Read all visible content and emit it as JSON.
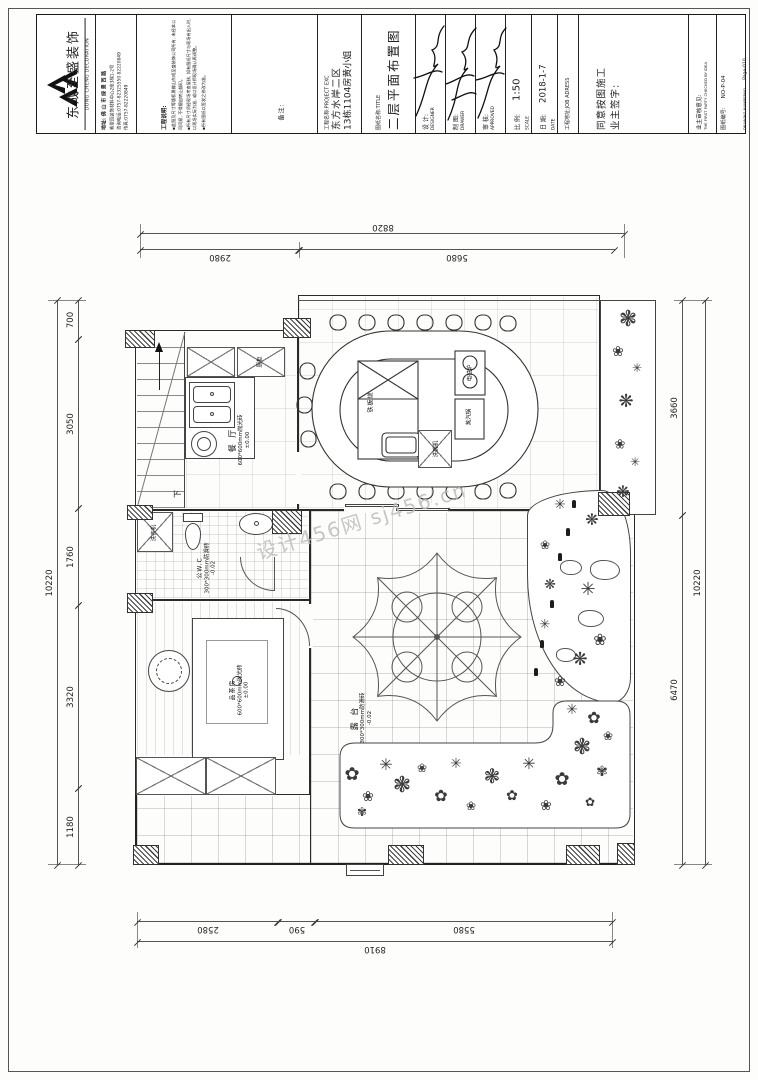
{
  "watermark": "设计456网 sj456.cn",
  "icons": {
    "flower_a": "✿",
    "flower_b": "❀",
    "flower_c": "✾",
    "star": "✳",
    "burst": "❋",
    "tree": "❃"
  },
  "title_block": {
    "company": {
      "name": "东成至盛装饰",
      "name_en": "DONG CHENG DECORATION",
      "address_line1": "地址: 佛 山 市 绿 景 西 路",
      "address_line2": "紫翠园装饰材料中心2座3梯1-2号",
      "tel": "咨询电话:0757-82325550 82220849",
      "fax": "传真:0757-82220849"
    },
    "notes": {
      "heading": "工程说明:",
      "item1": "▪此图及尺寸等版权属佛山东成至盛装饰公司所有, 未经本公司同意, 不得擅自转让翻印。",
      "item2": "▪所有尺寸须经现场考查复核, 如有图纸尺寸与现场有出入时, 以现场实际为准, 或以设计师现场确认再调整。",
      "item3": "▪所有图纸以签发之修改为准。"
    },
    "remark": "备注:",
    "project": {
      "label": "工程名称:PROJECT EXC",
      "line1": "东方水岸二区",
      "line2": "13栋1104房黄小姐"
    },
    "drawing": {
      "label": "图纸名称:TITLE",
      "name": "二层平面布置图"
    },
    "designer": {
      "label": "设 计:",
      "en": "DESIGNER"
    },
    "drawer": {
      "label": "制 图:",
      "en": "DRAWER"
    },
    "approver": {
      "label": "审 核:",
      "en": "APPROVED"
    },
    "scale": {
      "label": "比 例:",
      "en": "SCALE",
      "value": "1:50"
    },
    "date": {
      "label": "日 期:",
      "en": "DATE",
      "value": "2018-1-7"
    },
    "job_address": {
      "label": "工程地址:JOB ADRESS"
    },
    "owner": {
      "line1": "同意按图施工",
      "line2": "业主签字:"
    },
    "check": {
      "label": "业主审核意见:",
      "en": "THE FIRST PARTY CHECKED BY IDEA"
    },
    "number": {
      "label": "图纸编号:",
      "value": "NO-P-04",
      "en": "DRAWING NUMBERNO",
      "page": "Page-010"
    }
  },
  "dims": {
    "top": {
      "overall": "8820",
      "seg1": "2980",
      "seg2": "5680"
    },
    "bottom": {
      "seg1": "2580",
      "seg2": "590",
      "seg3": "5580",
      "overall": "8910"
    },
    "left": {
      "overall": "10220",
      "seg1": "700",
      "seg2": "3050",
      "seg3": "1760",
      "seg4": "3320",
      "seg5": "1180"
    },
    "right": {
      "seg1": "3660",
      "seg2": "6470",
      "overall": "10220"
    }
  },
  "plan": {
    "dining": {
      "name": "餐 厅",
      "tile": "600*600mm抛光砖",
      "level": "±0.00"
    },
    "cabinet": "厨柜",
    "teppanyaki": "铁板烧",
    "dishwasher": "洗碗机",
    "induction": "电磁炉",
    "steamer": "蒸汽锅",
    "wc": {
      "name": "公W.C",
      "tile": "300*300mm防滑砖",
      "level": "-0.02"
    },
    "washer": "洗衣机",
    "tea": {
      "name": "品茶房",
      "tile": "600*600mm抛光砖",
      "level": "±0.00"
    },
    "terrace": {
      "name": "露 台",
      "tile": "300*300mm防滑砖",
      "level": "-0.02"
    },
    "stairs_down": "下"
  }
}
